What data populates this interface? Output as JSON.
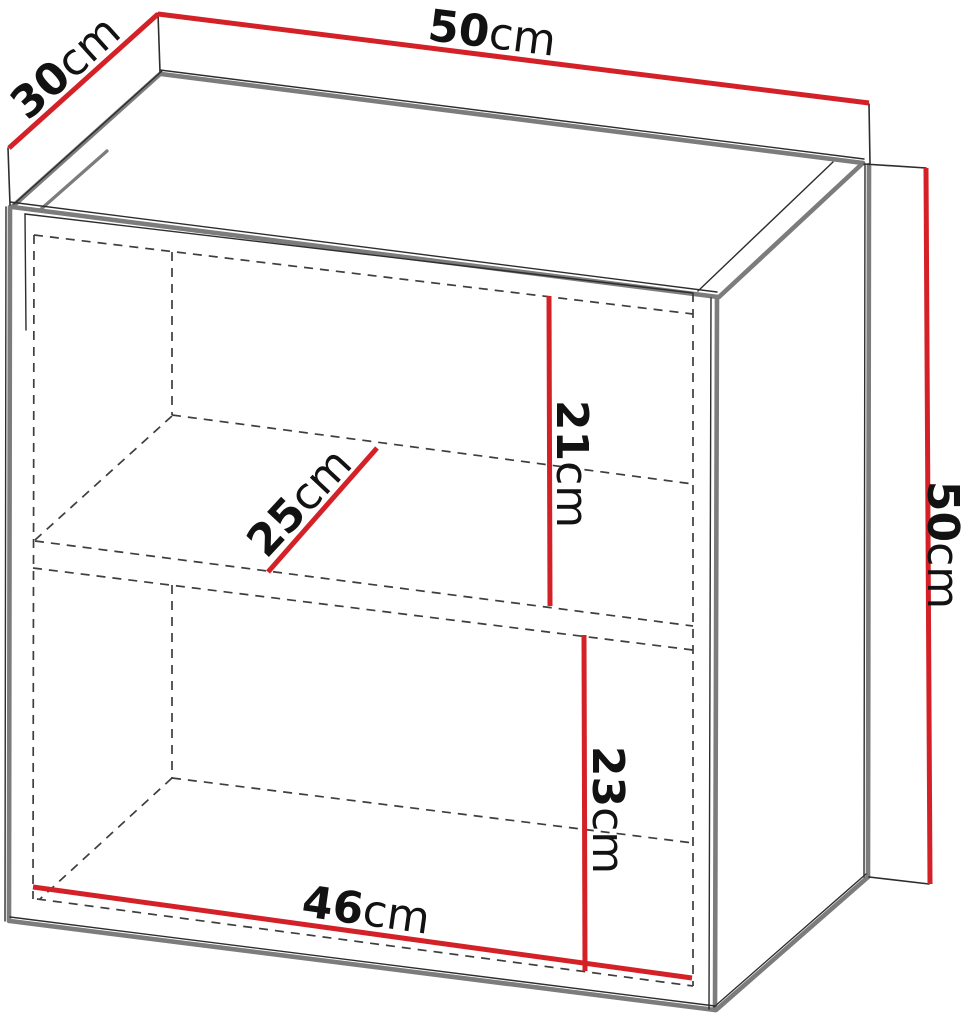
{
  "diagram": {
    "type": "furniture-dimension-diagram",
    "dimensions": {
      "top_width": {
        "value": "50",
        "unit": "cm"
      },
      "top_depth": {
        "value": "30",
        "unit": "cm"
      },
      "height": {
        "value": "50",
        "unit": "cm"
      },
      "upper_section_height": {
        "value": "21",
        "unit": "cm"
      },
      "shelf_depth": {
        "value": "25",
        "unit": "cm"
      },
      "lower_section_height": {
        "value": "23",
        "unit": "cm"
      },
      "interior_width": {
        "value": "46",
        "unit": "cm"
      }
    }
  },
  "colors": {
    "dimension_line": "#d42127",
    "edge_gray": "#7c7c7c",
    "edge_outline": "#2d2d2d",
    "hidden_line": "#3e3e3e",
    "label_text": "#121212",
    "background": "#ffffff"
  }
}
